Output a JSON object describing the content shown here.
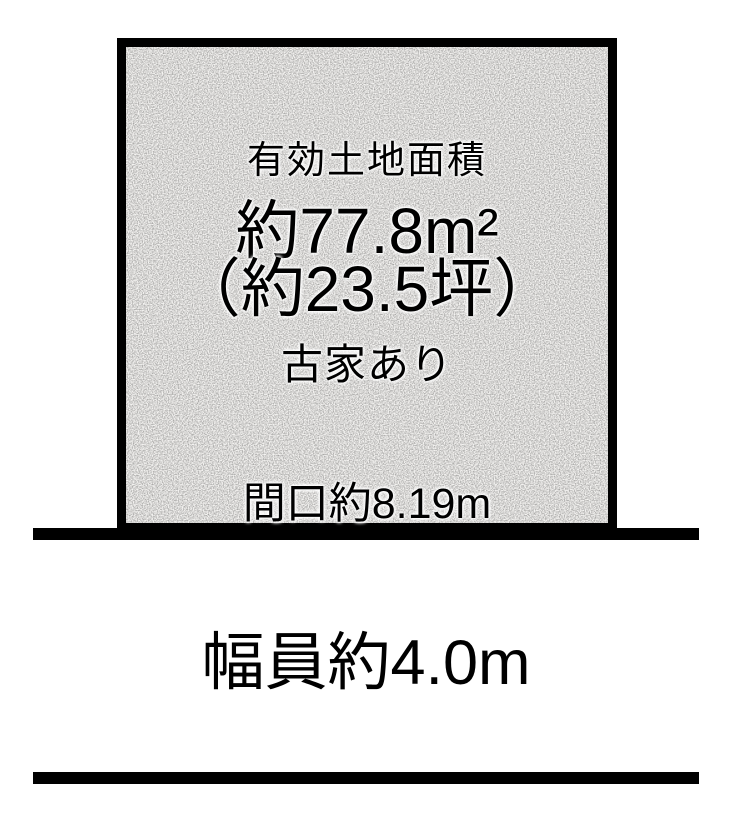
{
  "colors": {
    "ink": "#000000",
    "background": "#ffffff",
    "plot_fill": "#f5f4f2"
  },
  "plot": {
    "area_title": "有効土地面積",
    "area_sqm": "約77.8m²",
    "area_tsubo": "（約23.5坪）",
    "building_note": "古家あり",
    "frontage_label": "間口約8.19m"
  },
  "road": {
    "width_label": "幅員約4.0m"
  }
}
